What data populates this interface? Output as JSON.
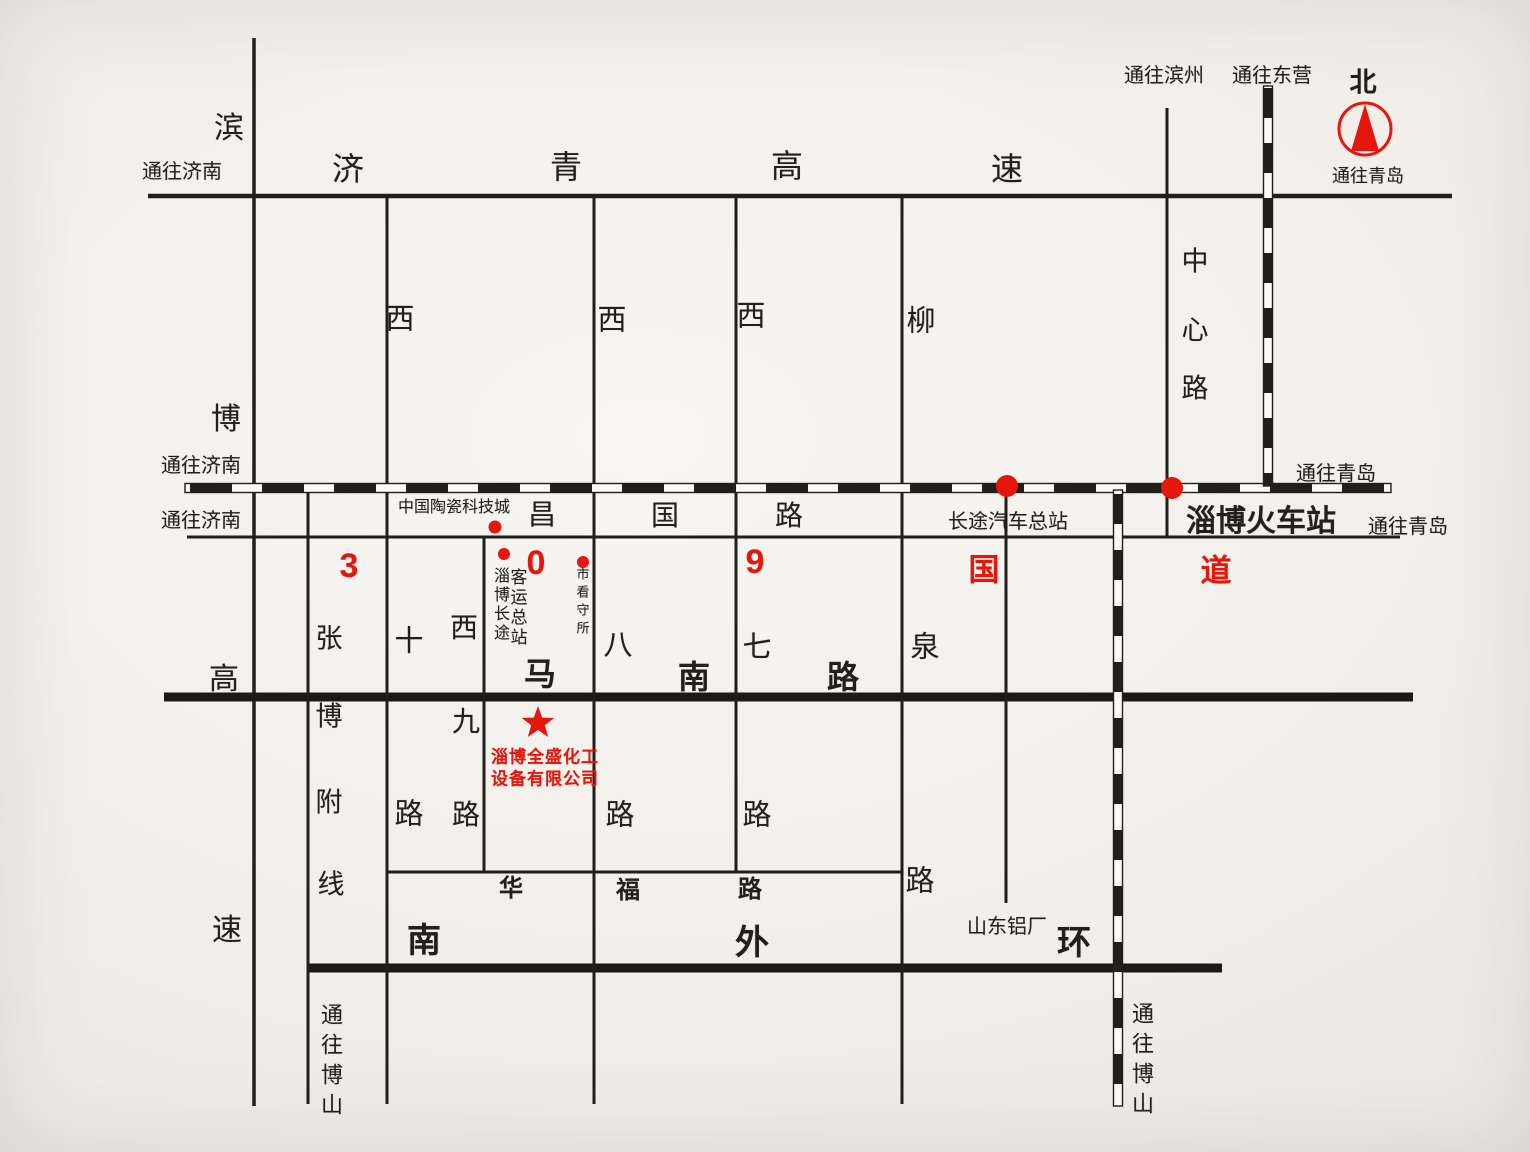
{
  "colors": {
    "paper": "#f1eeea",
    "ink": "#231f1b",
    "red": "#e5170c"
  },
  "labels": [
    {
      "name": "binbo-char-bin",
      "text": "滨",
      "x": 229,
      "y": 129,
      "size": 30
    },
    {
      "name": "to-jinan-expressway",
      "text": "通往济南",
      "x": 182,
      "y": 172,
      "size": 20
    },
    {
      "name": "jiqing-char-ji",
      "text": "济",
      "x": 348,
      "y": 169,
      "size": 32
    },
    {
      "name": "jiqing-char-qing",
      "text": "青",
      "x": 566,
      "y": 167,
      "size": 32
    },
    {
      "name": "jiqing-char-gao",
      "text": "高",
      "x": 787,
      "y": 166,
      "size": 32
    },
    {
      "name": "jiqing-char-su",
      "text": "速",
      "x": 1007,
      "y": 169,
      "size": 32
    },
    {
      "name": "to-binzhou",
      "text": "通往滨州",
      "x": 1164,
      "y": 76,
      "size": 20
    },
    {
      "name": "to-dongying",
      "text": "通往东营",
      "x": 1272,
      "y": 76,
      "size": 20
    },
    {
      "name": "north-char",
      "text": "北",
      "x": 1363,
      "y": 83,
      "size": 27,
      "bold": true
    },
    {
      "name": "to-qingdao-compass",
      "text": "通往青岛",
      "x": 1368,
      "y": 176,
      "size": 18
    },
    {
      "name": "center-road-char-zhong",
      "text": "中",
      "x": 1195,
      "y": 262,
      "size": 27
    },
    {
      "name": "center-road-char-xin",
      "text": "心",
      "x": 1195,
      "y": 331,
      "size": 27
    },
    {
      "name": "center-road-char-lu",
      "text": "路",
      "x": 1195,
      "y": 389,
      "size": 27
    },
    {
      "name": "west10-char-xi",
      "text": "西",
      "x": 400,
      "y": 320,
      "size": 29
    },
    {
      "name": "west8-char-xi",
      "text": "西",
      "x": 612,
      "y": 321,
      "size": 29
    },
    {
      "name": "west7-char-xi",
      "text": "西",
      "x": 751,
      "y": 317,
      "size": 29
    },
    {
      "name": "liuquan-char-liu",
      "text": "柳",
      "x": 921,
      "y": 322,
      "size": 29
    },
    {
      "name": "to-jinan-railway",
      "text": "通往济南",
      "x": 201,
      "y": 466,
      "size": 20
    },
    {
      "name": "to-qingdao-railway",
      "text": "通往青岛",
      "x": 1336,
      "y": 474,
      "size": 20
    },
    {
      "name": "to-jinan-changguo",
      "text": "通往济南",
      "x": 201,
      "y": 521,
      "size": 20
    },
    {
      "name": "ceramics-city",
      "text": "中国陶瓷科技城",
      "x": 454,
      "y": 508,
      "size": 16
    },
    {
      "name": "changguo-char-chang",
      "text": "昌",
      "x": 542,
      "y": 515,
      "size": 28
    },
    {
      "name": "changguo-char-guo",
      "text": "国",
      "x": 665,
      "y": 516,
      "size": 28
    },
    {
      "name": "changguo-char-lu",
      "text": "路",
      "x": 789,
      "y": 516,
      "size": 28
    },
    {
      "name": "bus-terminal-label",
      "text": "长途汽车总站",
      "x": 1008,
      "y": 522,
      "size": 20
    },
    {
      "name": "railway-station-label",
      "text": "淄博火车站",
      "x": 1261,
      "y": 522,
      "size": 30,
      "bold": true
    },
    {
      "name": "to-qingdao-changguo",
      "text": "通往青岛",
      "x": 1408,
      "y": 527,
      "size": 20
    },
    {
      "name": "g309-char-3",
      "text": "3",
      "x": 349,
      "y": 566,
      "size": 34,
      "bold": true,
      "color": "red"
    },
    {
      "name": "g309-char-0",
      "text": "0",
      "x": 536,
      "y": 563,
      "size": 34,
      "bold": true,
      "color": "red"
    },
    {
      "name": "g309-char-9",
      "text": "9",
      "x": 755,
      "y": 562,
      "size": 34,
      "bold": true,
      "color": "red"
    },
    {
      "name": "g309-char-guo",
      "text": "国",
      "x": 984,
      "y": 570,
      "size": 31,
      "bold": true,
      "color": "red"
    },
    {
      "name": "g309-char-dao",
      "text": "道",
      "x": 1216,
      "y": 571,
      "size": 31,
      "bold": true,
      "color": "red"
    },
    {
      "name": "coach-terminal-col1",
      "text": "淄博长途",
      "x": 499,
      "y": 605,
      "size": 16,
      "dir": "v",
      "ls": 3
    },
    {
      "name": "coach-terminal-col2",
      "text": "客运总站",
      "x": 517,
      "y": 608,
      "size": 17,
      "dir": "v",
      "ls": 3
    },
    {
      "name": "detention-house",
      "text": "市看守所",
      "x": 582,
      "y": 603,
      "size": 13,
      "dir": "v",
      "ls": 5
    },
    {
      "name": "zhangbo-char-zhang",
      "text": "张",
      "x": 329,
      "y": 639,
      "size": 27
    },
    {
      "name": "zhangbo-char-bo",
      "text": "博",
      "x": 329,
      "y": 717,
      "size": 27
    },
    {
      "name": "zhangbo-char-fu",
      "text": "附",
      "x": 329,
      "y": 803,
      "size": 27
    },
    {
      "name": "zhangbo-char-xian",
      "text": "线",
      "x": 331,
      "y": 885,
      "size": 27
    },
    {
      "name": "west10-char-shi",
      "text": "十",
      "x": 409,
      "y": 642,
      "size": 29
    },
    {
      "name": "west10-char-lu",
      "text": "路",
      "x": 409,
      "y": 815,
      "size": 29
    },
    {
      "name": "west9-char-xi",
      "text": "西",
      "x": 464,
      "y": 628,
      "size": 28
    },
    {
      "name": "west9-char-jiu",
      "text": "九",
      "x": 466,
      "y": 722,
      "size": 28
    },
    {
      "name": "west9-char-lu",
      "text": "路",
      "x": 466,
      "y": 815,
      "size": 28
    },
    {
      "name": "west8-char-ba",
      "text": "八",
      "x": 618,
      "y": 646,
      "size": 29
    },
    {
      "name": "west8-char-lu",
      "text": "路",
      "x": 620,
      "y": 816,
      "size": 29
    },
    {
      "name": "west7-char-qi",
      "text": "七",
      "x": 757,
      "y": 648,
      "size": 29
    },
    {
      "name": "west7-char-lu",
      "text": "路",
      "x": 757,
      "y": 816,
      "size": 29
    },
    {
      "name": "liuquan-char-quan",
      "text": "泉",
      "x": 925,
      "y": 648,
      "size": 29
    },
    {
      "name": "liuquan-char-lu",
      "text": "路",
      "x": 920,
      "y": 882,
      "size": 29
    },
    {
      "name": "manan-char-ma",
      "text": "马",
      "x": 540,
      "y": 674,
      "size": 32,
      "bold": true
    },
    {
      "name": "manan-char-nan",
      "text": "南",
      "x": 694,
      "y": 677,
      "size": 32,
      "bold": true
    },
    {
      "name": "manan-char-lu",
      "text": "路",
      "x": 843,
      "y": 677,
      "size": 32,
      "bold": true
    },
    {
      "name": "company-name-line1",
      "text": "淄博全盛化工",
      "x": 545,
      "y": 757,
      "size": 17,
      "bold": true,
      "color": "red",
      "ls": 1
    },
    {
      "name": "company-name-line2",
      "text": "设备有限公司",
      "x": 545,
      "y": 779,
      "size": 17,
      "bold": true,
      "color": "red",
      "ls": 1
    },
    {
      "name": "binbo-char-bo",
      "text": "博",
      "x": 226,
      "y": 420,
      "size": 30
    },
    {
      "name": "binbo-char-gao",
      "text": "高",
      "x": 224,
      "y": 680,
      "size": 30
    },
    {
      "name": "binbo-char-su",
      "text": "速",
      "x": 227,
      "y": 931,
      "size": 30
    },
    {
      "name": "huafu-char-hua",
      "text": "华",
      "x": 511,
      "y": 889,
      "size": 24,
      "bold": true
    },
    {
      "name": "huafu-char-fu",
      "text": "福",
      "x": 628,
      "y": 891,
      "size": 24,
      "bold": true
    },
    {
      "name": "huafu-char-lu",
      "text": "路",
      "x": 750,
      "y": 890,
      "size": 24,
      "bold": true
    },
    {
      "name": "ring-char-nan",
      "text": "南",
      "x": 424,
      "y": 941,
      "size": 34,
      "bold": true
    },
    {
      "name": "ring-char-wai",
      "text": "外",
      "x": 752,
      "y": 943,
      "size": 34,
      "bold": true
    },
    {
      "name": "ring-char-huan",
      "text": "环",
      "x": 1074,
      "y": 943,
      "size": 34,
      "bold": true
    },
    {
      "name": "aluminum-plant",
      "text": "山东铝厂",
      "x": 1007,
      "y": 927,
      "size": 20
    },
    {
      "name": "to-boshan-west",
      "text": "通往博山",
      "x": 330,
      "y": 1063,
      "size": 22,
      "dir": "v",
      "ls": 8
    },
    {
      "name": "to-boshan-east",
      "text": "通往博山",
      "x": 1141,
      "y": 1062,
      "size": 22,
      "dir": "v",
      "ls": 8
    }
  ]
}
